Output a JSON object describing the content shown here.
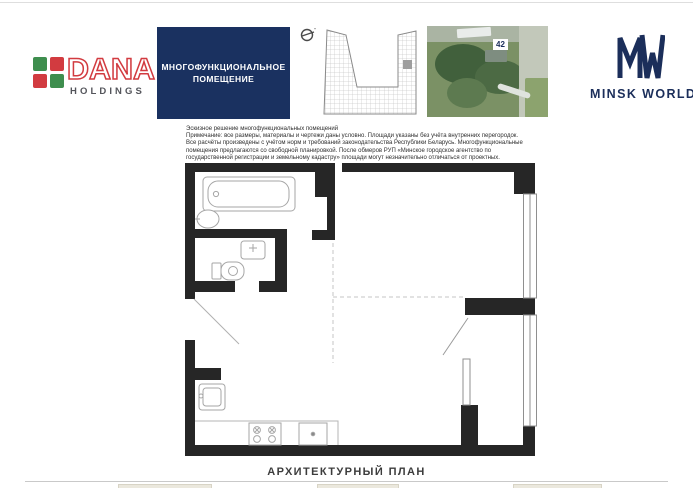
{
  "brand_left": {
    "name": "DANA",
    "subtitle": "HOLDINGS"
  },
  "title_box": {
    "line1": "МНОГОФУНКЦИОНАЛЬНОЕ",
    "line2": "ПОМЕЩЕНИЕ"
  },
  "site_map": {
    "building_marker": "42"
  },
  "brand_right": {
    "name": "MINSK WORLD"
  },
  "disclaimer": {
    "lines": [
      "Эскизное решение многофункциональных помещений",
      "Примечание: все размеры, материалы и чертежи даны условно. Площади указаны без учёта внутренних перегородок.",
      "Все расчёты произведены с учётом норм и требований законодательства Республики Беларусь. Многофункциональные",
      "помещения предлагаются со свободной планировкой. После обмеров РУП «Минское городское агентство по",
      "государственной регистрации и земельному кадастру» площади могут незначительно отличаться от проектных."
    ]
  },
  "plan": {
    "caption": "АРХИТЕКТУРНЫЙ ПЛАН",
    "fixtures": [
      "bathtub",
      "washbasin",
      "toilet",
      "wc-sink",
      "kitchen-sink",
      "stove",
      "oven"
    ],
    "features": [
      "entrance-opening",
      "free-plan-dashed-partitions",
      "windows-right-wall",
      "balcony-room-bottom-right"
    ]
  },
  "colors": {
    "navy": "#1a3160",
    "mw_navy": "#1b2e5a",
    "dana_red": "#d23b40",
    "dana_green": "#3e8e4e",
    "wall": "#262626",
    "fixture_line": "#a6a6a6"
  }
}
